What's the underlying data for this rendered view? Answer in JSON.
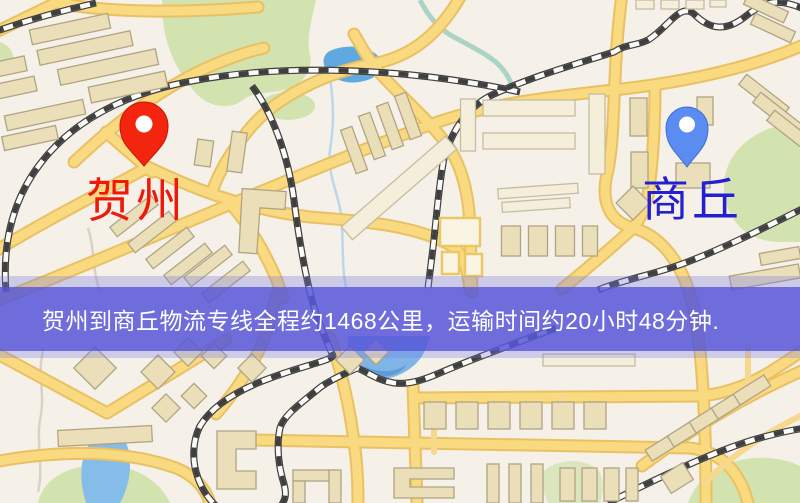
{
  "banner": {
    "text": "贺州到商丘物流专线全程约1468公里，运输时间约20小时48分钟.",
    "background_color": "#5757d8",
    "text_color": "#ffffff"
  },
  "markers": {
    "origin": {
      "label": "贺州",
      "label_color": "#f01808",
      "pin_color": "#f3250f",
      "icon": "map-pin-icon"
    },
    "destination": {
      "label": "商丘",
      "label_color": "#2420cf",
      "pin_color": "#5a8cf2",
      "icon": "map-pin-icon"
    }
  },
  "map": {
    "colors": {
      "background": "#f5f0e8",
      "road_fill": "#f9da80",
      "road_casing": "#e9c163",
      "park": "#d3e3b0",
      "water": "#7fb5e6",
      "lake_deep": "#60a8e0",
      "building": "#ebdfba",
      "building_light": "#f4eedb",
      "railway": "#3f3f3f"
    }
  }
}
